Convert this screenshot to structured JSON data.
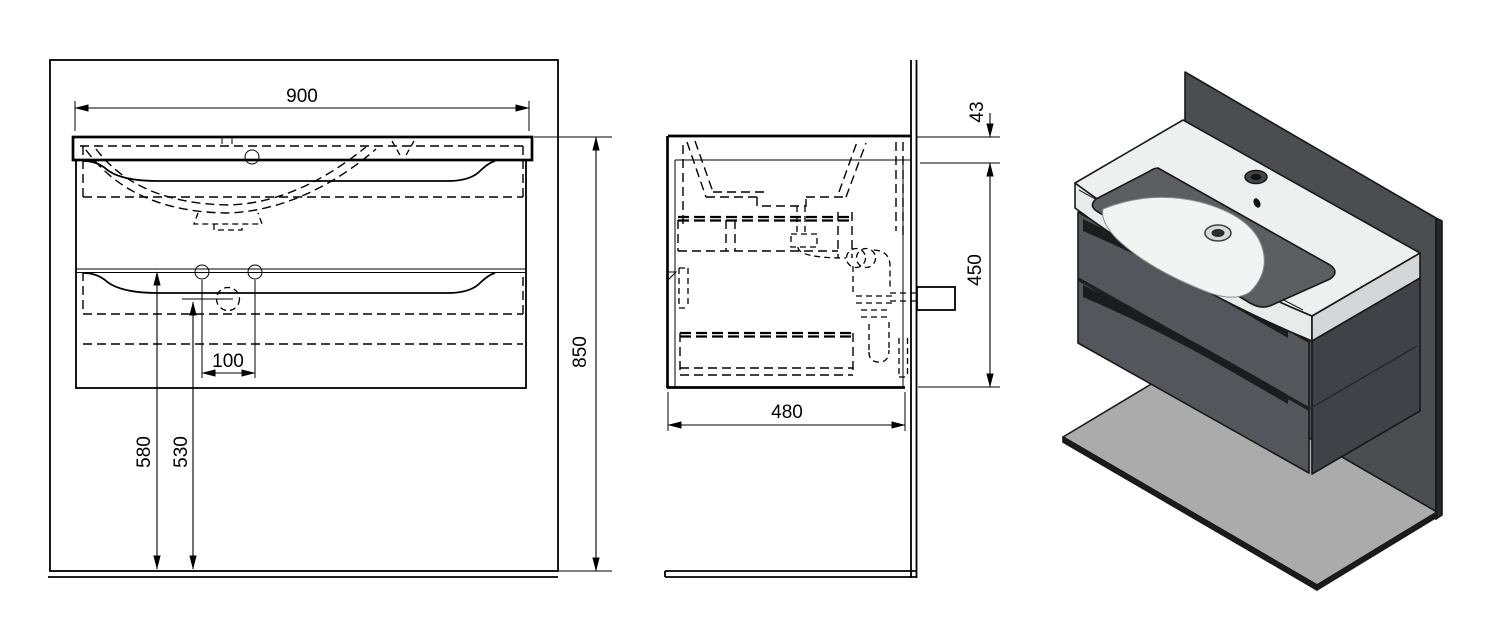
{
  "labels": {
    "front_width": "900",
    "front_height": "850",
    "hole_spacing": "100",
    "divider_height": "580",
    "hole_height": "530",
    "side_top_offset": "43",
    "side_cabinet_height": "450",
    "side_depth": "480"
  },
  "dimensions_mm": {
    "width": 900,
    "overall_height": 850,
    "depth": 480,
    "cabinet_height": 450,
    "countertop_lip": 43,
    "hole_spacing": 100,
    "floor_to_drawer_divider": 580,
    "floor_to_hole": 530
  },
  "colors": {
    "line": "#000000",
    "wall_panel": "#4b4d51",
    "wall_edge": "#26272a",
    "floor_panel": "#ababab",
    "floor_edge": "#1c1c1c",
    "cabinet_front": "#54565b",
    "cabinet_side": "#3f4247",
    "ceramic_top": "#eef0f0",
    "ceramic_front": "#e9eaea",
    "ceramic_side": "#d5d6d7",
    "basin_interior": "#5c5e62",
    "basin_floor": "#f2f3f3",
    "handle_recess": "#1b1c1e",
    "divider_gap": "#1e1f21"
  }
}
